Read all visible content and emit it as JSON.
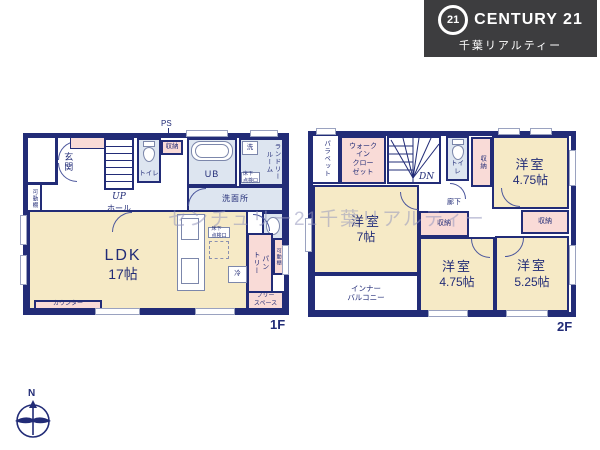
{
  "branding": {
    "mark": "21",
    "name": "CENTURY 21",
    "subtitle": "千葉リアルティー"
  },
  "watermark": {
    "text": "センチュリー21千葉リアルティー"
  },
  "compass": {
    "north": "N"
  },
  "colors": {
    "wall": "#222c77",
    "room_cream": "#f6eac6",
    "room_pink": "#f9dbd7",
    "room_blue": "#dde5f0",
    "logo_bg": "#3d3d3f"
  },
  "floor1": {
    "label": "1F",
    "ps": "PS",
    "entrance": "玄関",
    "shelf_left": "可動棚",
    "up": "UP",
    "hall": "ホール",
    "toilet": "トイレ",
    "storage": "収納",
    "bath": "UB",
    "washer": "洗",
    "laundry": "ランドリー\nルーム",
    "hatch": "床下\n点検口",
    "washroom": "洗面所",
    "ldk": {
      "name": "LDK",
      "size": "17帖"
    },
    "counter": "カウンター",
    "hatch2": "床下\n点検口",
    "fridge": "冷",
    "pantry": "パン\nトリー",
    "shelf_right": "可動棚",
    "free_space": "フリー\nスペース"
  },
  "floor2": {
    "label": "2F",
    "parapet": "パラペット",
    "wic": "ウォーク\nイン\nクロー\nゼット",
    "dn": "DN",
    "toilet": "トイレ",
    "storage_top": "収納",
    "corridor": "廊下",
    "storage_mid": "収納",
    "storage_right": "収納",
    "room_tr": {
      "name": "洋室",
      "size": "4.75帖"
    },
    "room_left": {
      "name": "洋室",
      "size": "7帖"
    },
    "room_bc": {
      "name": "洋室",
      "size": "4.75帖"
    },
    "room_br": {
      "name": "洋室",
      "size": "5.25帖"
    },
    "balcony": "インナー\nバルコニー"
  }
}
